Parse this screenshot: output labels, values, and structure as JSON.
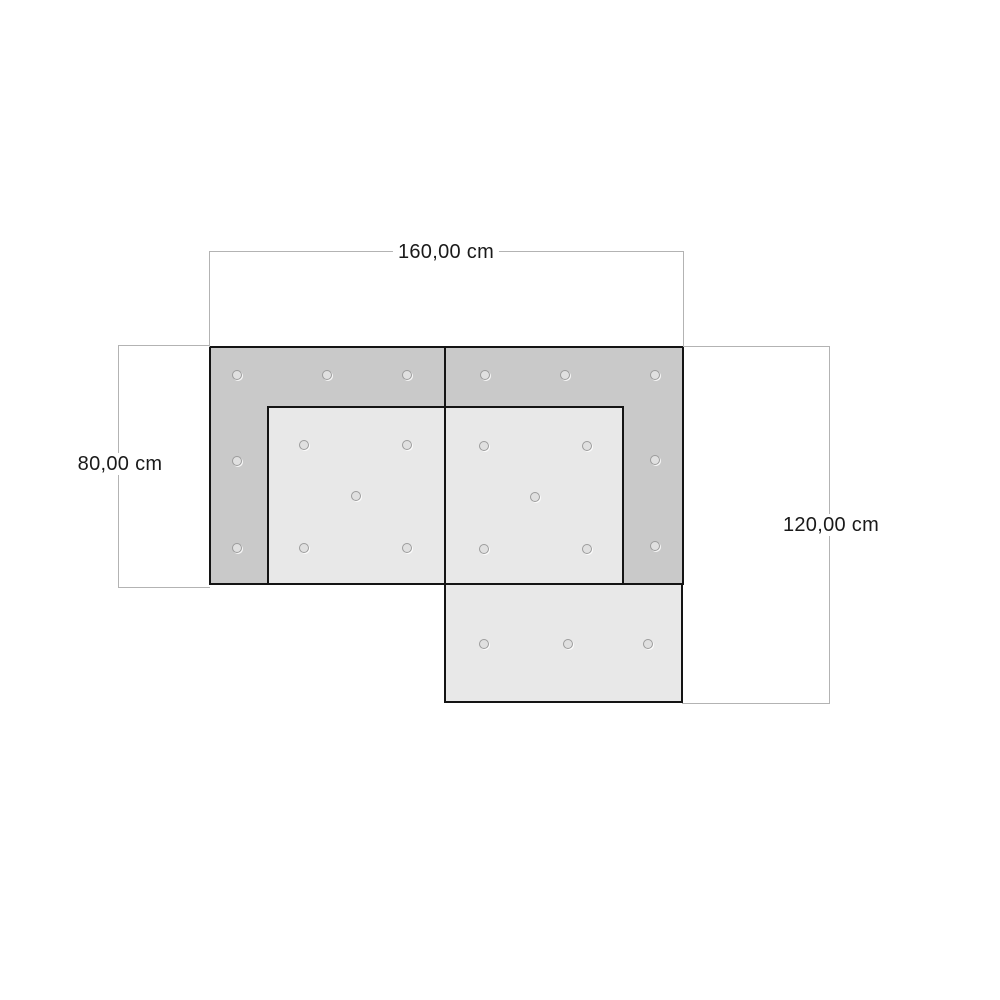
{
  "diagram": {
    "dimensions": {
      "top_width": "160,00 cm",
      "left_height": "80,00 cm",
      "right_height": "120,00 cm"
    },
    "colors": {
      "background": "#ffffff",
      "frame_fill": "#c9c9c9",
      "cushion_fill": "#e8e8e8",
      "outline": "#141414",
      "dimension_line": "#b3b3b3",
      "text": "#1a1a1a",
      "button_ring": "#9c9c9c",
      "button_fill": "#e0e0e0"
    },
    "icons": {
      "tufting_button": "○"
    }
  }
}
